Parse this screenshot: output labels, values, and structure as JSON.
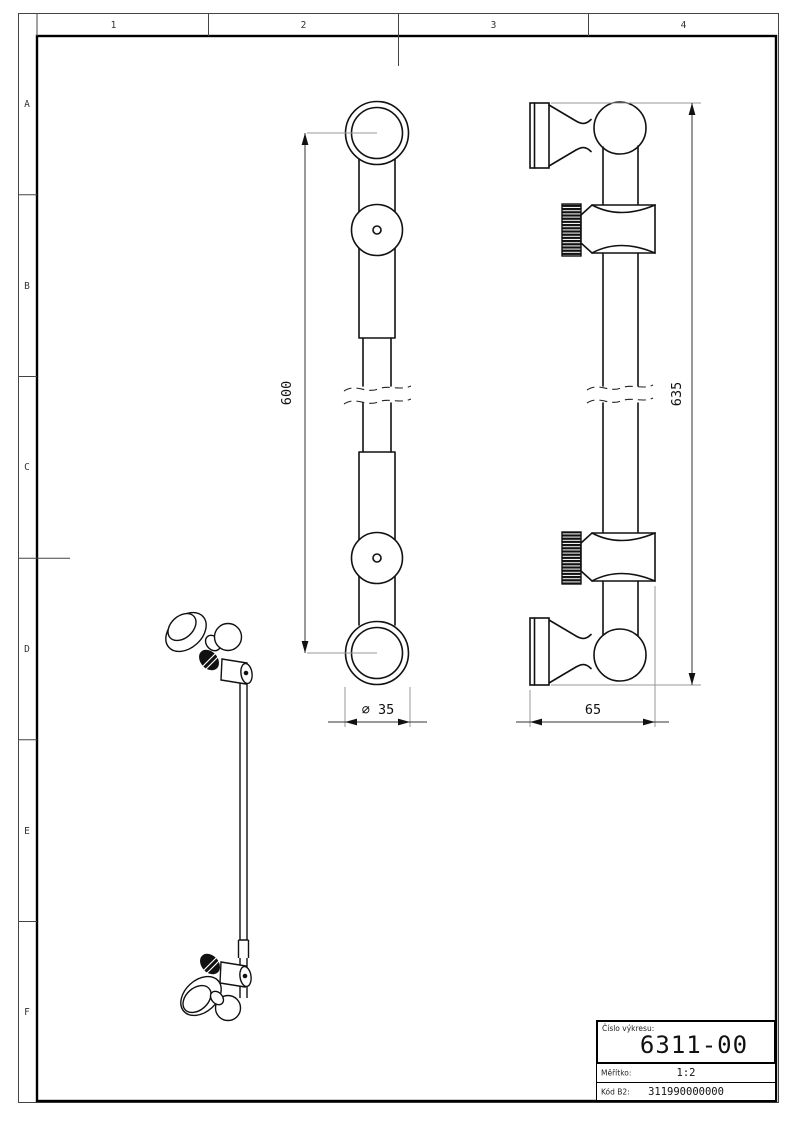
{
  "colors": {
    "background": "#ffffff",
    "outline": "#111111",
    "dimension_line": "#333333",
    "extension_line": "#999999"
  },
  "frame": {
    "columns": [
      "1",
      "2",
      "3",
      "4"
    ],
    "rows": [
      "A",
      "B",
      "C",
      "D",
      "E",
      "F"
    ]
  },
  "dims": {
    "front_length": "600",
    "overall_length": "635",
    "diameter": "∅ 35",
    "wall_offset": "65"
  },
  "title_block": {
    "number_label": "Číslo výkresu:",
    "number": "6311-00",
    "scale_label": "Měřítko:",
    "scale": "1:2",
    "code_label": "Kód B2:",
    "code": "311990000000"
  }
}
